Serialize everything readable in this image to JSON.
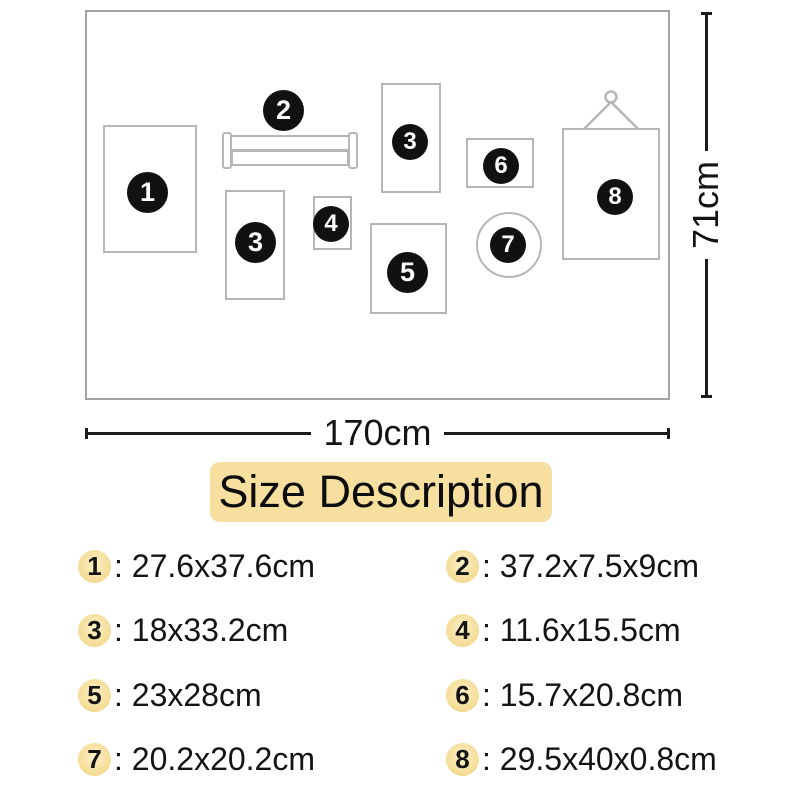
{
  "diagram": {
    "badges": [
      "1",
      "2",
      "3",
      "3",
      "4",
      "5",
      "6",
      "7",
      "8"
    ],
    "dimensions": {
      "width": "170cm",
      "height": "71cm"
    }
  },
  "size_description": {
    "title": "Size Description",
    "separator": ": ",
    "items": [
      {
        "num": "1",
        "size": "27.6x37.6cm"
      },
      {
        "num": "2",
        "size": "37.2x7.5x9cm"
      },
      {
        "num": "3",
        "size": "18x33.2cm"
      },
      {
        "num": "4",
        "size": "11.6x15.5cm"
      },
      {
        "num": "5",
        "size": "23x28cm"
      },
      {
        "num": "6",
        "size": "15.7x20.8cm"
      },
      {
        "num": "7",
        "size": "20.2x20.2cm"
      },
      {
        "num": "8",
        "size": "29.5x40x0.8cm"
      }
    ]
  },
  "colors": {
    "accent_yellow": "#f7dfa0",
    "badge_black": "#111111",
    "outline_grey": "#b6b6b6",
    "line_black": "#1c1c1c"
  }
}
